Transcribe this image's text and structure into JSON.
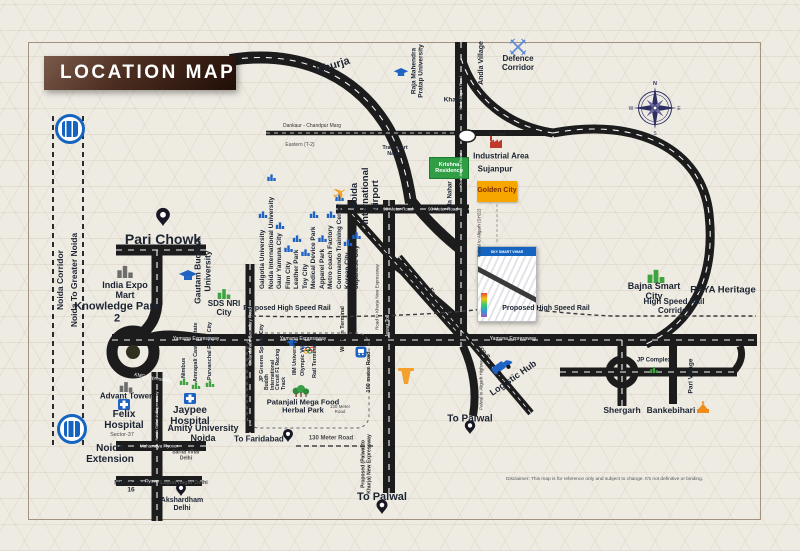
{
  "header": {
    "title": "LOCATION MAP"
  },
  "metro_corridor": {
    "label1": "Noida Corridor",
    "label2": "Noida To Greater Noida"
  },
  "projects": {
    "krishna_residency": "Krishna Residency",
    "golden_city": "Golden City",
    "site_plan_title": "SKY SMART VIHAR"
  },
  "noida_area": {
    "pari_chowk": "Pari Chowk",
    "india_expo_mart": "India Expo Mart",
    "knowledge_park_2": "Knowledge Park 2",
    "gautam_buddha_university": "Gautam Buddha University",
    "sds_nri_city": "SDS NRI City",
    "advant_tower": "Advant Tower",
    "felix_hospital": "Felix Hospital",
    "jaypee_hospital": "Jaypee Hospital",
    "amity_university": "Amity University Noida",
    "sector_37": "Sector-37",
    "noida_extension": "Noida Extension",
    "noida_sec_16": "Noida Sec-16",
    "sarita_vihar": "Sarita Vihar Delhi",
    "lajpat_nagar": "Lajpat nagar Delhi",
    "akshardham": "Akshardham Delhi",
    "mahamaya_flyover": "Mahamaya Flyover",
    "flyover": "Flyover",
    "kmg_expressway": "KMG Expressway",
    "noida_gnoida_expressway": "Noida G.Noida Expressway"
  },
  "poi_column": [
    "Galgotia University",
    "Noida International University",
    "Gaur Yamuna City",
    "Film City",
    "Leather Park",
    "Toy City",
    "Medical Device Park",
    "Apparel Park",
    "Metro coach Factory",
    "Commando Training Center",
    "Korean City",
    "Japanese City"
  ],
  "estates_column": [
    "Nimbus",
    "Amrapali Castle Estate",
    "Purvanchal Royal City"
  ],
  "south_column": [
    "JP Greens Sports City",
    "Buddh International Circuit F1 Racing Track",
    "IIM University",
    "Olympic Village",
    "Rail Terminal Site"
  ],
  "airport": {
    "name": "Noida International Airport",
    "western_terminal": "Western Terminal"
  },
  "jewar_area": {
    "khurja": "Khurja",
    "khair": "Khair",
    "to_khair": "To Khair",
    "andla_village": "Andla Village",
    "defence_corridor": "Defence Corridor",
    "raja_mahendra_pratap_university": "Raja Mahendra Pratap University",
    "transport_nagar": "Transport Nagar",
    "industrial_area": "Industrial Area",
    "sujanpur": "Sujanpur",
    "sola_nahar": "Sola Nahar",
    "jewar_toll": "Jewar Toll",
    "logistic_hub": "Logistic Hub",
    "patanjali_park": "Patanjali Mega Food Herbal Park"
  },
  "east_area": {
    "bajna_smart_city": "Bajna Smart City",
    "raya_heritage": "RAYA Heritage",
    "high_speed_rail_corridor": "High Speed Rail Corridor",
    "proposed_high_speed_rail": "Proposed High Speed Rail",
    "jp_complex": "JP Complex",
    "shergarh": "Shergarh",
    "bankebihari": "Bankebihari",
    "pari_village": "Pari Village"
  },
  "roads": {
    "yamuna_expressway": "Yamuna Expressway",
    "ninety_meter_road": "90 Meter Road",
    "hundred_meter_road": "100 meter Road",
    "one_thirty_meter_road": "130 Meter Road",
    "eco_s": "Eco-S",
    "eastern_t2": "Eastern (T-2)",
    "dankaur_chandpur_marg": "Dankaur - Chandpur Marg",
    "khair_aligarh_road": "Khair Aligarh Road",
    "palwal_aligarh_sh22": "Palwal to Aligarh (SH22)",
    "palwal_aligarh_highway": "Palwal to Aligarh Highway",
    "road_to_khurja": "Road to Khurja New Expressway",
    "proposed_palwal_khurja": "Proposed (Palwal to Khurja) New Expressway",
    "bulandshahr_boundary_road": "Bulandshahr Boundary Road"
  },
  "destinations": {
    "to_palwal": "To Palwal",
    "to_faridabad": "To Faridabad"
  },
  "compass": {
    "n": "N",
    "e": "E",
    "s": "S",
    "w": "W"
  },
  "icons": {
    "plane_glyph": "✈"
  },
  "disclaimer": "Disclaimer: This map is for reference only and subject to change. It's not definitive or binding."
}
